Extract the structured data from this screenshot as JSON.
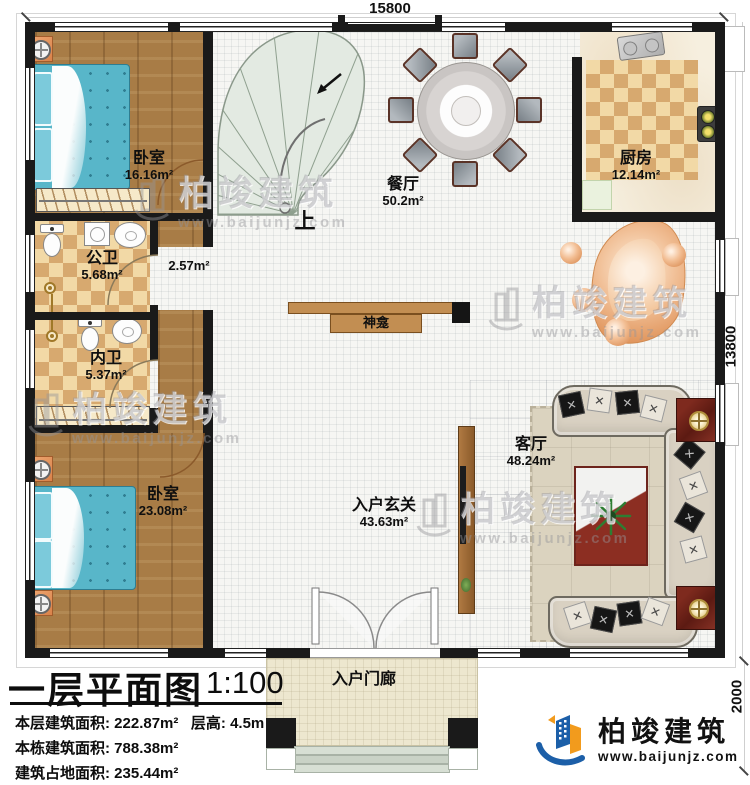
{
  "dimensions": {
    "top": "15800",
    "right": "13800",
    "porch_depth": "2000"
  },
  "rooms": {
    "bedroom_top": {
      "name": "卧室",
      "area": "16.16m²"
    },
    "dining": {
      "name": "餐厅",
      "area": "50.2m²"
    },
    "kitchen": {
      "name": "厨房",
      "area": "12.14m²"
    },
    "corridor": {
      "area": "2.57m²"
    },
    "public_bath": {
      "name": "公卫",
      "area": "5.68m²"
    },
    "private_bath": {
      "name": "内卫",
      "area": "5.37m²"
    },
    "bedroom_bottom": {
      "name": "卧室",
      "area": "23.08m²"
    },
    "living": {
      "name": "客厅",
      "area": "48.24m²"
    },
    "foyer": {
      "name": "入户玄关",
      "area": "43.63m²"
    },
    "porch": {
      "name": "入户门廊"
    },
    "shrine": {
      "name": "神龛"
    },
    "stairs": {
      "up_label": "上"
    }
  },
  "title_block": {
    "title": "一层平面图",
    "scale": "1:100",
    "floor_area_label": "本层建筑面积:",
    "floor_area_value": "222.87m²",
    "height_label": "层高:",
    "height_value": "4.5m",
    "building_area_label": "本栋建筑面积:",
    "building_area_value": "788.38m²",
    "footprint_label": "建筑占地面积:",
    "footprint_value": "235.44m²"
  },
  "brand": {
    "name": "柏竣建筑",
    "url": "www.baijunjz.com"
  },
  "watermark": {
    "name": "柏竣建筑",
    "url": "www.baijunjz.com"
  },
  "colors": {
    "wall": "#1a1a1a",
    "wood_floor": "#a87c46",
    "bed": "#58b6c9",
    "bath_tile_light": "#f2d9a6",
    "bath_tile_dark": "#d7a96f",
    "stair": "#e3eae2",
    "brand_blue": "#1c5fa8",
    "brand_orange": "#f29b1d",
    "side_table_red": "#6e231b",
    "decor_orange": "#e8a470"
  }
}
